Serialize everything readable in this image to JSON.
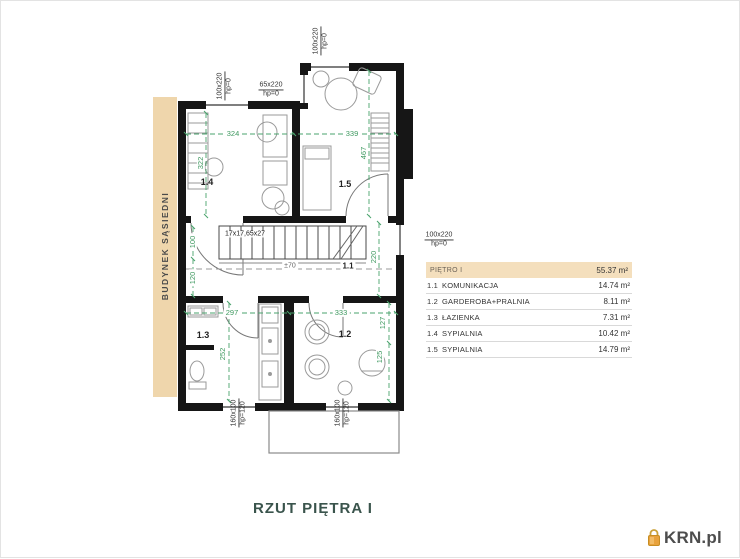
{
  "title": "RZUT PIĘTRA I",
  "watermark": {
    "brand": "KRN.pl"
  },
  "neighbor_strip": {
    "label": "BUDYNEK SĄSIEDNI"
  },
  "legend": {
    "header": {
      "label": "PIĘTRO I",
      "area": "55.37 m²"
    },
    "rows": [
      {
        "no": "1.1",
        "name": "KOMUNIKACJA",
        "area": "14.74 m²"
      },
      {
        "no": "1.2",
        "name": "GARDEROBA+PRALNIA",
        "area": "8.11 m²"
      },
      {
        "no": "1.3",
        "name": "ŁAZIENKA",
        "area": "7.31 m²"
      },
      {
        "no": "1.4",
        "name": "SYPIALNIA",
        "area": "10.42 m²"
      },
      {
        "no": "1.5",
        "name": "SYPIALNIA",
        "area": "14.79 m²"
      }
    ]
  },
  "plan": {
    "room_labels": {
      "r11": "1.1",
      "r12": "1.2",
      "r13": "1.3",
      "r14": "1.4",
      "r15": "1.5"
    },
    "dimensions": {
      "room14_width": "324",
      "room14_depth": "322",
      "room15_width": "339",
      "room15_depth": "467",
      "hall_upper": "100",
      "hall_lower": "120",
      "hall_right": "220",
      "room13_width": "297",
      "room13_depth": "252",
      "room12_width": "333",
      "room12_depth_upper": "127",
      "room12_depth_lower": "125"
    },
    "stairs_spec": "17x17,65x27",
    "level_mark": "±70",
    "openings": {
      "win_top_left": {
        "size": "100x220",
        "sill": "hp=0"
      },
      "win_top_small": {
        "size": "65x220",
        "sill": "hp=0"
      },
      "win_top_right": {
        "size": "100x220",
        "sill": "hp=0"
      },
      "door_right": {
        "size": "100x220",
        "sill": "hp=0"
      },
      "win_bottom_left": {
        "size": "160x100",
        "sill": "hp=120"
      },
      "win_bottom_right": {
        "size": "160x100",
        "sill": "hp=120"
      }
    }
  },
  "colors": {
    "wall": "#161616",
    "dimension_green": "#3f9960",
    "band_beige": "#f4dfbd",
    "strip_beige": "#efd6ac",
    "title": "#3a544c",
    "logo_orange": "#e8a23c",
    "logo_text": "#4d4d4d"
  }
}
